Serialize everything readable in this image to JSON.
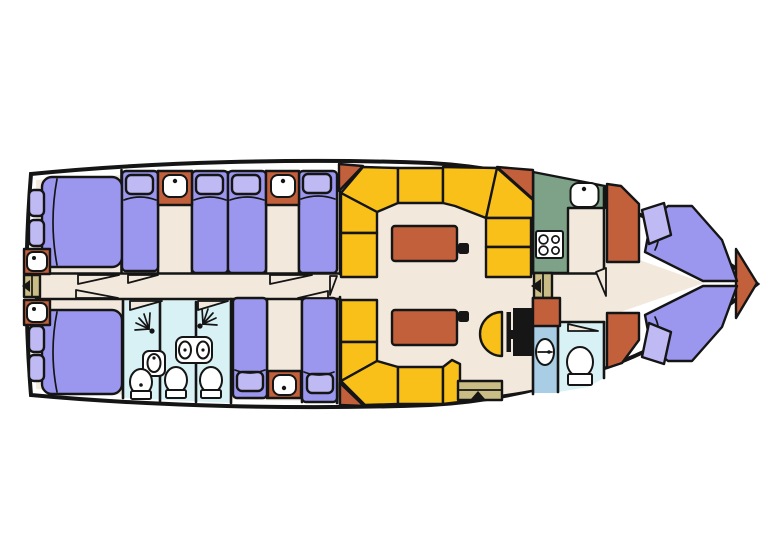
{
  "title": "yacht-deck-floor-plan",
  "palette": {
    "background": "#ffffff",
    "outline": "#151515",
    "floor": "#F2E9DC",
    "bed": "#9B97EF",
    "pillow": "#BFBAF3",
    "terracotta": "#C2603C",
    "bench_yellow": "#F8C018",
    "galley_green": "#7DA287",
    "wet_room": "#D8F1F5",
    "shower_blue": "#A9CDE5",
    "steps_tan": "#C9BC85",
    "fixture_white": "#FFFFFF",
    "console_black": "#161616"
  },
  "plan": {
    "orientation": "bow-right",
    "features": {
      "aft_double_beds": 2,
      "single_beds_upper_row": 4,
      "single_beds_lower_row": 2,
      "v_berth_beds": 2,
      "washbasin_cabinets": 5,
      "shower_spray_heads": 2,
      "toilets": 4,
      "wet_rooms": 3,
      "dinette_tables": 2,
      "dinette_bench_color": "yellow",
      "galley_stove_burners": 4,
      "galley_sinks": 1,
      "helm_seat_shape": "semicircle",
      "companionway_steps": 3
    },
    "icons": {
      "washbasin-icon": "rounded-square-basin-with-tap-dot",
      "shower-icon": "spray-dot-with-fan-lines",
      "toilet-icon": "oval-bowl-with-cistern",
      "stove-icon": "four-burner-hob",
      "sink-icon": "oval-basin",
      "entry-arrow-icon": "black-triangle",
      "table-mount-icon": "small-dark-square"
    }
  }
}
